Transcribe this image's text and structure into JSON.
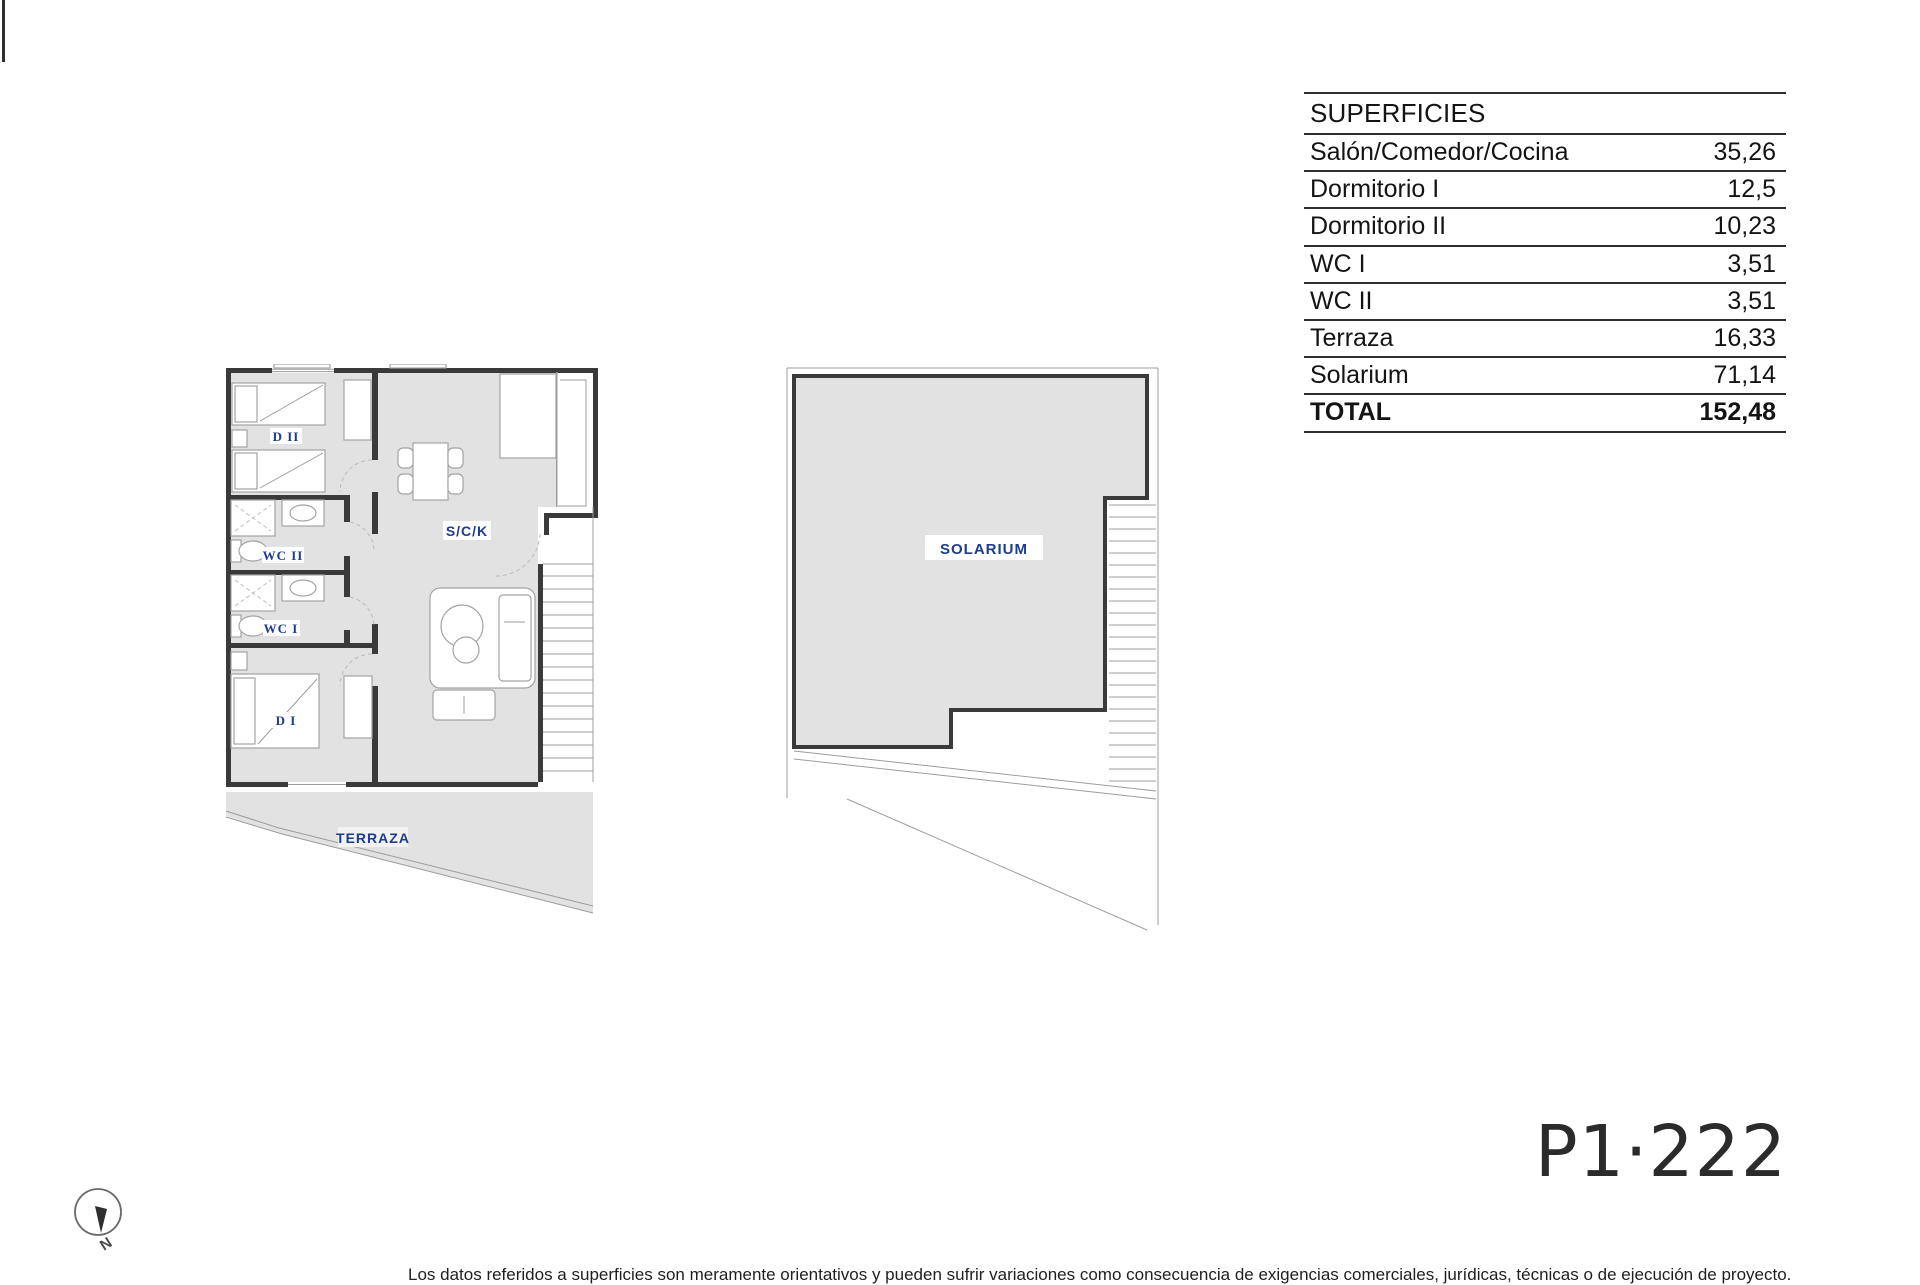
{
  "surfaces_table": {
    "header": "SUPERFICIES",
    "rows": [
      {
        "label": "Salón/Comedor/Cocina",
        "value": "35,26",
        "bold": false
      },
      {
        "label": "Dormitorio I",
        "value": "12,5",
        "bold": false
      },
      {
        "label": "Dormitorio II",
        "value": "10,23",
        "bold": false
      },
      {
        "label": "WC I",
        "value": "3,51",
        "bold": false
      },
      {
        "label": "WC II",
        "value": "3,51",
        "bold": false
      },
      {
        "label": "Terraza",
        "value": "16,33",
        "bold": false
      },
      {
        "label": "Solarium",
        "value": "71,14",
        "bold": false
      },
      {
        "label": "TOTAL",
        "value": "152,48",
        "bold": true
      }
    ]
  },
  "plan_left": {
    "labels": {
      "dormitorio2": "D II",
      "wc2": "WC II",
      "wc1": "WC I",
      "dormitorio1": "D I",
      "salon": "S/C/K",
      "terraza": "TERRAZA"
    }
  },
  "plan_right": {
    "label": "SOLARIUM"
  },
  "compass": {
    "north": "N"
  },
  "plan_code": "P1·222",
  "disclaimer": "Los datos referidos a superficies son meramente orientativos y pueden sufrir variaciones como consecuencia de exigencias comerciales, jurídicas, técnicas o de ejecución de proyecto.",
  "colors": {
    "floor_fill": "#e2e2e2",
    "wall": "#3a3a3a",
    "label_navy": "#1d3c8f",
    "thin_line": "#9c9c9c",
    "text_dark": "#141414"
  }
}
